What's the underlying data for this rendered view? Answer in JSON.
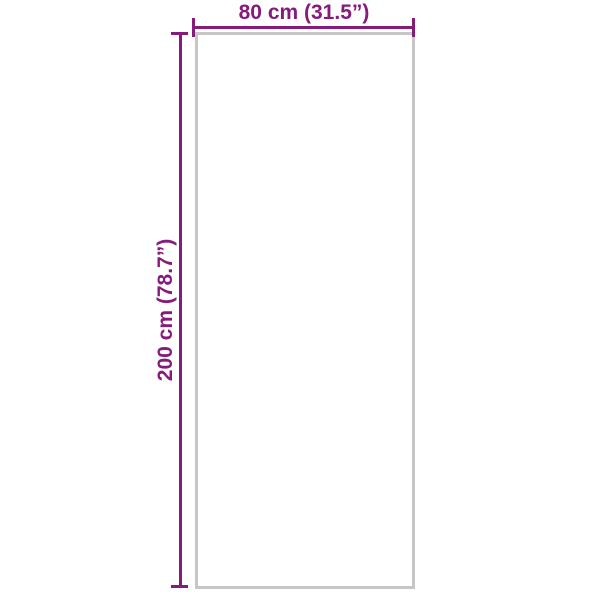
{
  "diagram": {
    "type": "product-dimension-diagram",
    "width_label": "80 cm (31.5”)",
    "height_label": "200 cm (78.7”)",
    "width_value_cm": 80,
    "width_value_inch": 31.5,
    "height_value_cm": 200,
    "height_value_inch": 78.7,
    "colors": {
      "dimension_accent": "#861a7d",
      "product_outline": "#c6c6c6",
      "background": "#ffffff"
    }
  }
}
